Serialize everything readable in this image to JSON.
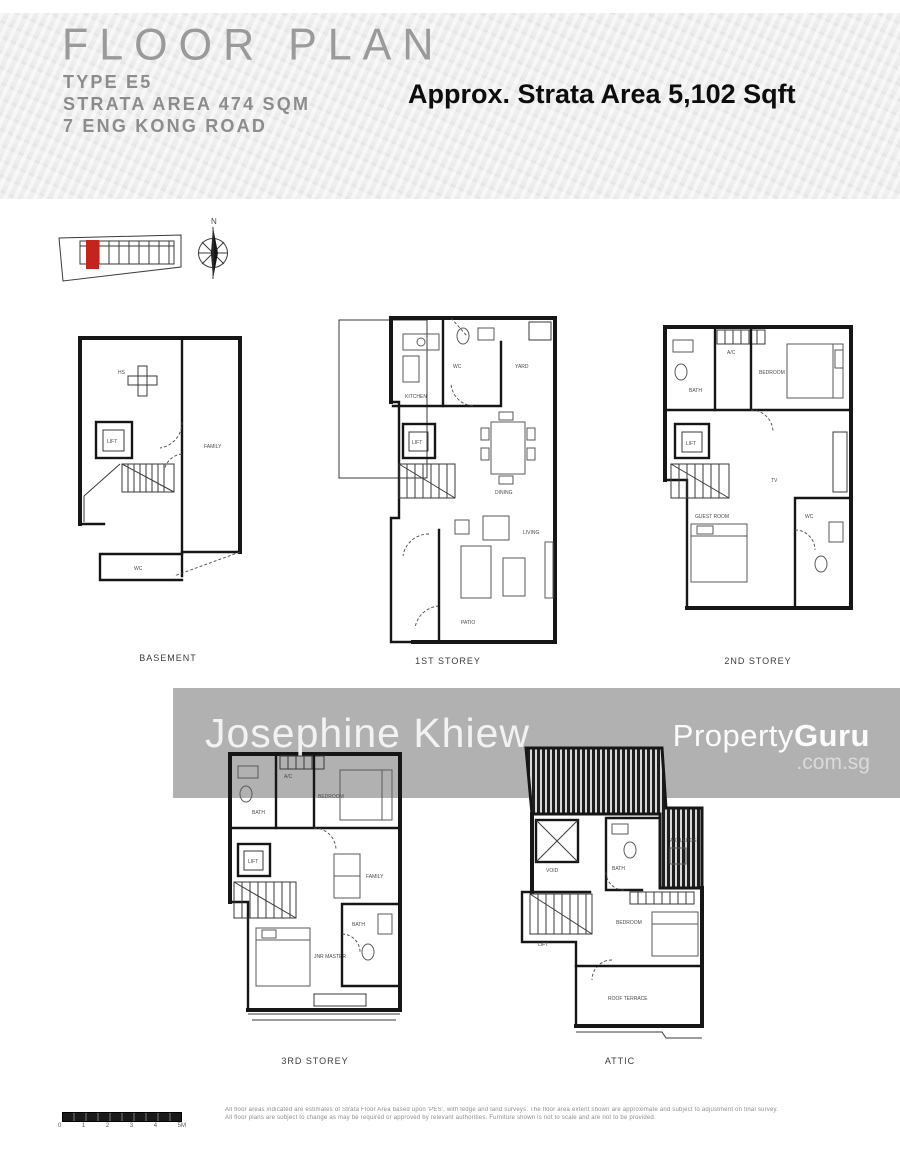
{
  "header": {
    "title": "FLOOR PLAN",
    "type_line": "TYPE E5",
    "area_line": "STRATA AREA 474 SQM",
    "address_line": "7 ENG KONG ROAD",
    "approx_area": "Approx. Strata Area 5,102 Sqft"
  },
  "site_plan": {
    "highlight_color": "#c3241e",
    "compass_label": "N"
  },
  "floors": {
    "basement": {
      "caption": "BASEMENT",
      "rooms": {
        "shelter": "HS",
        "lift": "LIFT",
        "family": "FAMILY",
        "wc": "WC"
      }
    },
    "first": {
      "caption": "1ST STOREY",
      "rooms": {
        "kitchen": "KITCHEN",
        "wc": "WC",
        "yard": "YARD",
        "lift": "LIFT",
        "dining": "DINING",
        "living": "LIVING",
        "patio": "PATIO"
      }
    },
    "second": {
      "caption": "2ND STOREY",
      "rooms": {
        "bath": "BATH",
        "ac": "A/C",
        "bedroom": "BEDROOM",
        "tv": "TV",
        "lift": "LIFT",
        "guest": "GUEST ROOM",
        "wc": "WC"
      }
    },
    "third": {
      "caption": "3RD STOREY",
      "rooms": {
        "bath": "BATH",
        "ac": "A/C",
        "bedroom": "BEDROOM",
        "family": "FAMILY",
        "lift": "LIFT",
        "jnr": "JNR MASTER",
        "bath2": "BATH"
      }
    },
    "attic": {
      "caption": "ATTIC",
      "rooms": {
        "void": "VOID",
        "lift": "LIFT",
        "bath": "BATH",
        "ac": "A/C LEDGE",
        "bedroom": "BEDROOM",
        "terrace": "ROOF TERRACE"
      }
    }
  },
  "watermark": {
    "agent": "Josephine Khiew",
    "brand_light": "Property",
    "brand_bold": "Guru",
    "brand_domain": ".com.sg"
  },
  "footer": {
    "scale_ticks": [
      "0",
      "1",
      "2",
      "3",
      "4",
      "5M"
    ],
    "disclaimer_line1": "All floor areas indicated are estimates of Strata Floor Area based upon 'PES', with ledge and land surveys. The floor area extent shown are approximate and subject to adjustment on final survey.",
    "disclaimer_line2": "All floor plans are subject to change as may be required or approved by relevant authorities. Furniture shown is not to scale and are not to be provided."
  }
}
